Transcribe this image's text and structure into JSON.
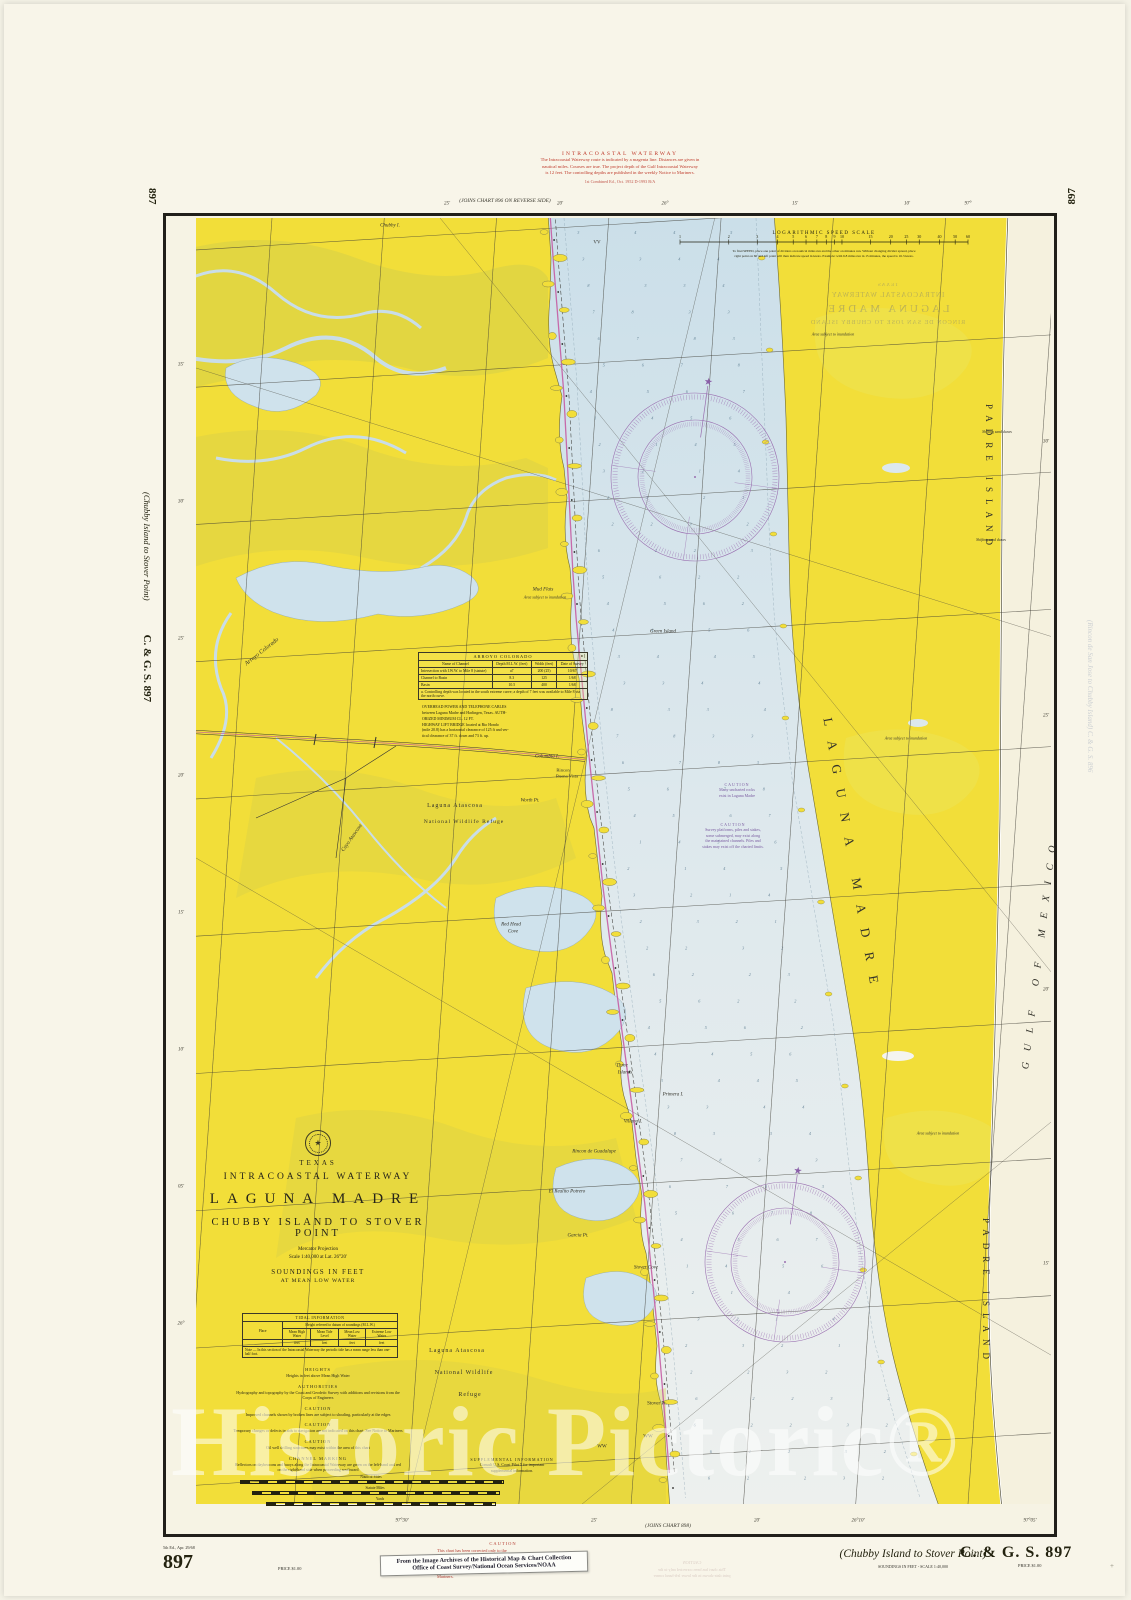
{
  "page": {
    "watermark": "Historic Pictoric®"
  },
  "top_note": {
    "title": "INTRACOASTAL WATERWAY",
    "lines": [
      "The Intracoastal Waterway route is indicated by a magenta line.   Distances are given in",
      "nautical miles.    Courses are true.    The project depth of the Gulf Intracoastal Waterway",
      "is 12 feet.    The controlling depths are published in the weekly Notice to Mariners."
    ],
    "edition": "1st Combined Ed., Oct. 1952        D-1993 B/A"
  },
  "margins": {
    "top_join": "(JOINS CHART 896 ON REVERSE SIDE)",
    "bottom_join": "(JOINS CHART 898)",
    "left_top_number": "897",
    "right_top_number": "897",
    "left_vertical_title": "(Chubby Island to Stover Point)",
    "left_vertical_id": "C. & G. S.  897",
    "showthrough_right": "(Rincon de San Jose to Chubby Island)    C. & G. S.  896"
  },
  "showthrough_top": {
    "lines": [
      "TEXAS",
      "INTRACOASTAL WATERWAY",
      "LAGUNA MADRE",
      "RINCON DE SAN JOSE TO CHUBBY ISLAND"
    ]
  },
  "showthrough_bottom": {
    "lines": [
      "CAUTION",
      "This chart has been corrected only to the",
      "print date shown in the lower left-hand corner"
    ]
  },
  "title_block": {
    "state": "TEXAS",
    "waterway": "INTRACOASTAL WATERWAY",
    "title": "LAGUNA MADRE",
    "subtitle": "CHUBBY ISLAND TO STOVER POINT",
    "projection": "Mercator Projection",
    "scale": "Scale 1:40,000 at Lat. 26°20'",
    "soundings1": "SOUNDINGS IN FEET",
    "soundings2": "AT MEAN LOW WATER"
  },
  "tidal_table": {
    "title": "TIDAL INFORMATION",
    "place_header": "Place",
    "span_header": "Height referred to datum of soundings (M.L.W.)",
    "columns": [
      "Mean High Water",
      "Mean Tide Level",
      "Mean Low Water",
      "Extreme Low Water"
    ],
    "units": [
      "feet",
      "feet",
      "feet",
      "feet"
    ],
    "note": "Note — In this section of the Intracoastal Waterway the periodic tide has a mean range less than one-half foot."
  },
  "notes_sections": [
    {
      "heading": "HEIGHTS",
      "body": "Heights in feet above Mean High Water"
    },
    {
      "heading": "AUTHORITIES",
      "body": "Hydrography and topography by the Coast and Geodetic Survey with additions and revisions from the Corps of Engineers"
    },
    {
      "heading": "CAUTION",
      "body": "Improved channels shown by broken lines are subject to shoaling, particularly at the edges"
    },
    {
      "heading": "CAUTION",
      "body": "Temporary changes or defects in aids to navigation are not indicated on this chart. See Notice to Mariners"
    },
    {
      "heading": "CAUTION",
      "body": "Oil well drilling structures may exist within the area of this chart"
    },
    {
      "heading": "CHANNEL MARKING",
      "body": "Reflectors on daybeacons and buoys along the Intracoastal Waterway are green on the left-hand and red on the right-hand side when proceeding southward"
    }
  ],
  "scale_bars": [
    "Nautical Miles",
    "Statute Miles",
    "Yards"
  ],
  "speed_scale": {
    "title": "LOGARITHMIC SPEED SCALE",
    "numbers": [
      1,
      2,
      3,
      4,
      5,
      6,
      7,
      8,
      9,
      10,
      15,
      20,
      25,
      30,
      40,
      50,
      60
    ],
    "caption1": "To find SPEED, place one point of dividers on nautical miles run and the other on minutes run.  Without changing divider spread, place",
    "caption2": "right point on 60 and left point will then indicate speed in knots.  Example: with 6.8 miles run in 15 minutes, the speed is 16.3 knots."
  },
  "arroyo_table": {
    "title": "ARROYO COLORADO",
    "headers": [
      "Name of Channel",
      "Depth M.L.W. (feet)",
      "Width (feet)",
      "Date of Survey"
    ],
    "rows": [
      [
        "Intersection with I.W.W. to Mile 8 (statute)",
        "a7",
        "200 (25)",
        "10/67"
      ],
      [
        "Channel to Basin",
        "8.3",
        "125",
        "1/68"
      ],
      [
        "Basin",
        "10.5",
        "400",
        "1/68"
      ]
    ],
    "footnote": "a. Controlling depth was located in the south extreme curve; a depth of 7 feet was available to Mile 8 via the north curve.",
    "cables_note": [
      "OVERHEAD POWER AND TELEPHONE CABLES",
      "between Laguna Madre and Harlingen, Texas.  AUTH-",
      "ORIZED MINIMUM CL. 12 FT.",
      "HIGHWAY LIFT BRIDGE located at Rio Hondo",
      "(mile 20.8) has a horizontal clearance of 125 ft and ver-",
      "tical clearance of 37 ft. down and 73 ft. up."
    ]
  },
  "footer": {
    "edition_note": "5th Ed., Apr. 29/68",
    "sheet_number": "897",
    "price_left": "PRICE $1.00",
    "caution_title": "CAUTION",
    "caution_lines": [
      "This chart has been corrected only to the",
      "print date shown in the lower left-hand",
      "corner. Corrections subsequent to this date",
      "should be made from the weekly Notice to",
      "Mariners."
    ],
    "sticker_line1": "From the Image Archives of the Historical Map & Chart Collection",
    "sticker_line2": "Office of Coast Survey/National Ocean Services/NOAA",
    "subtitle_italic": "(Chubby Island to Stover Point)",
    "soundings_note": "SOUNDINGS IN FEET - SCALE 1:40,000",
    "chart_id": "C. & G. S.  897",
    "price_right": "PRICE $1.00"
  },
  "map_labels": [
    {
      "t": "Chubby I.",
      "x": 390,
      "y": 226,
      "s": 5,
      "i": 1
    },
    {
      "t": "VV",
      "x": 597,
      "y": 243,
      "s": 5
    },
    {
      "t": "Mud Flats",
      "x": 543,
      "y": 590,
      "s": 5,
      "i": 1
    },
    {
      "t": "Area subject to inundation",
      "x": 545,
      "y": 597,
      "s": 4,
      "i": 1
    },
    {
      "t": "Green Island",
      "x": 663,
      "y": 632,
      "s": 5,
      "i": 1
    },
    {
      "t": "Arroyo Colorado",
      "x": 262,
      "y": 652,
      "s": 6,
      "i": 1,
      "r": -38
    },
    {
      "t": "Columbia I.",
      "x": 547,
      "y": 757,
      "s": 5,
      "i": 1
    },
    {
      "t": "Rincon",
      "x": 563,
      "y": 770,
      "s": 4.6
    },
    {
      "t": "Buena Vista",
      "x": 567,
      "y": 776,
      "s": 4.6
    },
    {
      "t": "Worth Pt.",
      "x": 530,
      "y": 801,
      "s": 5,
      "i": 1
    },
    {
      "t": "Laguna Atascosa",
      "x": 455,
      "y": 806,
      "s": 6,
      "ls": 1
    },
    {
      "t": "National Wildlife Refuge",
      "x": 464,
      "y": 822,
      "s": 5.6,
      "ls": 1
    },
    {
      "t": "Cayo Atascosa",
      "x": 352,
      "y": 838,
      "s": 5.4,
      "i": 1,
      "r": -55
    },
    {
      "t": "Red Head",
      "x": 511,
      "y": 925,
      "s": 5,
      "i": 1
    },
    {
      "t": "Cove",
      "x": 513,
      "y": 932,
      "s": 5,
      "i": 1
    },
    {
      "t": "Three",
      "x": 622,
      "y": 1066,
      "s": 5,
      "i": 1
    },
    {
      "t": "Islands",
      "x": 625,
      "y": 1073,
      "s": 5,
      "i": 1
    },
    {
      "t": "Primera I.",
      "x": 673,
      "y": 1095,
      "s": 5,
      "i": 1
    },
    {
      "t": "Villana I.",
      "x": 633,
      "y": 1122,
      "s": 5,
      "i": 1
    },
    {
      "t": "Rincon de Guadalupe",
      "x": 594,
      "y": 1152,
      "s": 5,
      "i": 1
    },
    {
      "t": "El Realito Potrero",
      "x": 567,
      "y": 1192,
      "s": 5,
      "i": 1
    },
    {
      "t": "Garcia Pt.",
      "x": 578,
      "y": 1236,
      "s": 5,
      "i": 1
    },
    {
      "t": "Stover Cove",
      "x": 646,
      "y": 1268,
      "s": 5,
      "i": 1
    },
    {
      "t": "Stover Pt.",
      "x": 657,
      "y": 1404,
      "s": 5
    },
    {
      "t": "WW",
      "x": 602,
      "y": 1447,
      "s": 5
    },
    {
      "t": "WW",
      "x": 648,
      "y": 1437,
      "s": 5
    },
    {
      "t": "Laguna Atascosa",
      "x": 457,
      "y": 1351,
      "s": 6,
      "ls": 1
    },
    {
      "t": "National Wildlife",
      "x": 464,
      "y": 1373,
      "s": 6,
      "ls": 1
    },
    {
      "t": "Refuge",
      "x": 470,
      "y": 1395,
      "s": 6,
      "ls": 1
    },
    {
      "t": "Area subject to inundation",
      "x": 833,
      "y": 334,
      "s": 4,
      "i": 1
    },
    {
      "t": "Area subject to inundation",
      "x": 906,
      "y": 738,
      "s": 4,
      "i": 1
    },
    {
      "t": "Area subject to inundation",
      "x": 938,
      "y": 1133,
      "s": 4,
      "i": 1
    },
    {
      "t": "Shifting sand dunes",
      "x": 997,
      "y": 432,
      "s": 3.8,
      "i": 1
    },
    {
      "t": "Shifting sand dunes",
      "x": 991,
      "y": 540,
      "s": 3.8,
      "i": 1
    },
    {
      "t": "PADRE ISLAND",
      "x": 989,
      "y": 478,
      "s": 9,
      "ls": 7,
      "r": 90
    },
    {
      "t": "PADRE ISLAND",
      "x": 986,
      "y": 1292,
      "s": 9,
      "ls": 7,
      "r": 90
    },
    {
      "t": "LAGUNA MADRE",
      "x": 852,
      "y": 858,
      "s": 13,
      "ls": 15,
      "r": 80
    },
    {
      "t": "GULF OF MEXICO",
      "x": 1040,
      "y": 952,
      "s": 10,
      "ls": 11,
      "r": -83,
      "i": 1
    }
  ],
  "map_notes": [
    {
      "x": 737,
      "y": 782,
      "c": "#7a5aa0",
      "lines": [
        "CAUTION",
        "Many uncharted rocks",
        "exist in Laguna Madre"
      ]
    },
    {
      "x": 733,
      "y": 822,
      "c": "#7a5aa0",
      "lines": [
        "CAUTION",
        "Survey platforms, piles and stakes,",
        "some submerged, may exist along",
        "the maintained channels. Piles and",
        "stakes may exist off the charted limits."
      ]
    },
    {
      "x": 512,
      "y": 1457,
      "c": "#2a2817",
      "lines": [
        "SUPPLEMENTAL INFORMATION",
        "Consult U.S. Coast Pilot 5 for important",
        "supplemental information."
      ]
    }
  ],
  "graticule_labels": {
    "top": [
      [
        "25'",
        447
      ],
      [
        "20'",
        560
      ],
      [
        "26°",
        665
      ],
      [
        "15'",
        795
      ],
      [
        "10'",
        907
      ],
      [
        "97°",
        968
      ]
    ],
    "left": [
      [
        "35'",
        365
      ],
      [
        "30'",
        502
      ],
      [
        "25'",
        639
      ],
      [
        "20'",
        776
      ],
      [
        "15'",
        913
      ],
      [
        "10'",
        1050
      ],
      [
        "05'",
        1187
      ],
      [
        "26°",
        1324
      ]
    ],
    "bottom": [
      [
        "97°30'",
        402
      ],
      [
        "25'",
        594
      ],
      [
        "20'",
        757
      ],
      [
        "26°10'",
        858
      ],
      [
        "97°05'",
        1030
      ]
    ],
    "right": [
      [
        "30'",
        442
      ],
      [
        "25'",
        716
      ],
      [
        "20'",
        990
      ],
      [
        "15'",
        1264
      ]
    ]
  }
}
